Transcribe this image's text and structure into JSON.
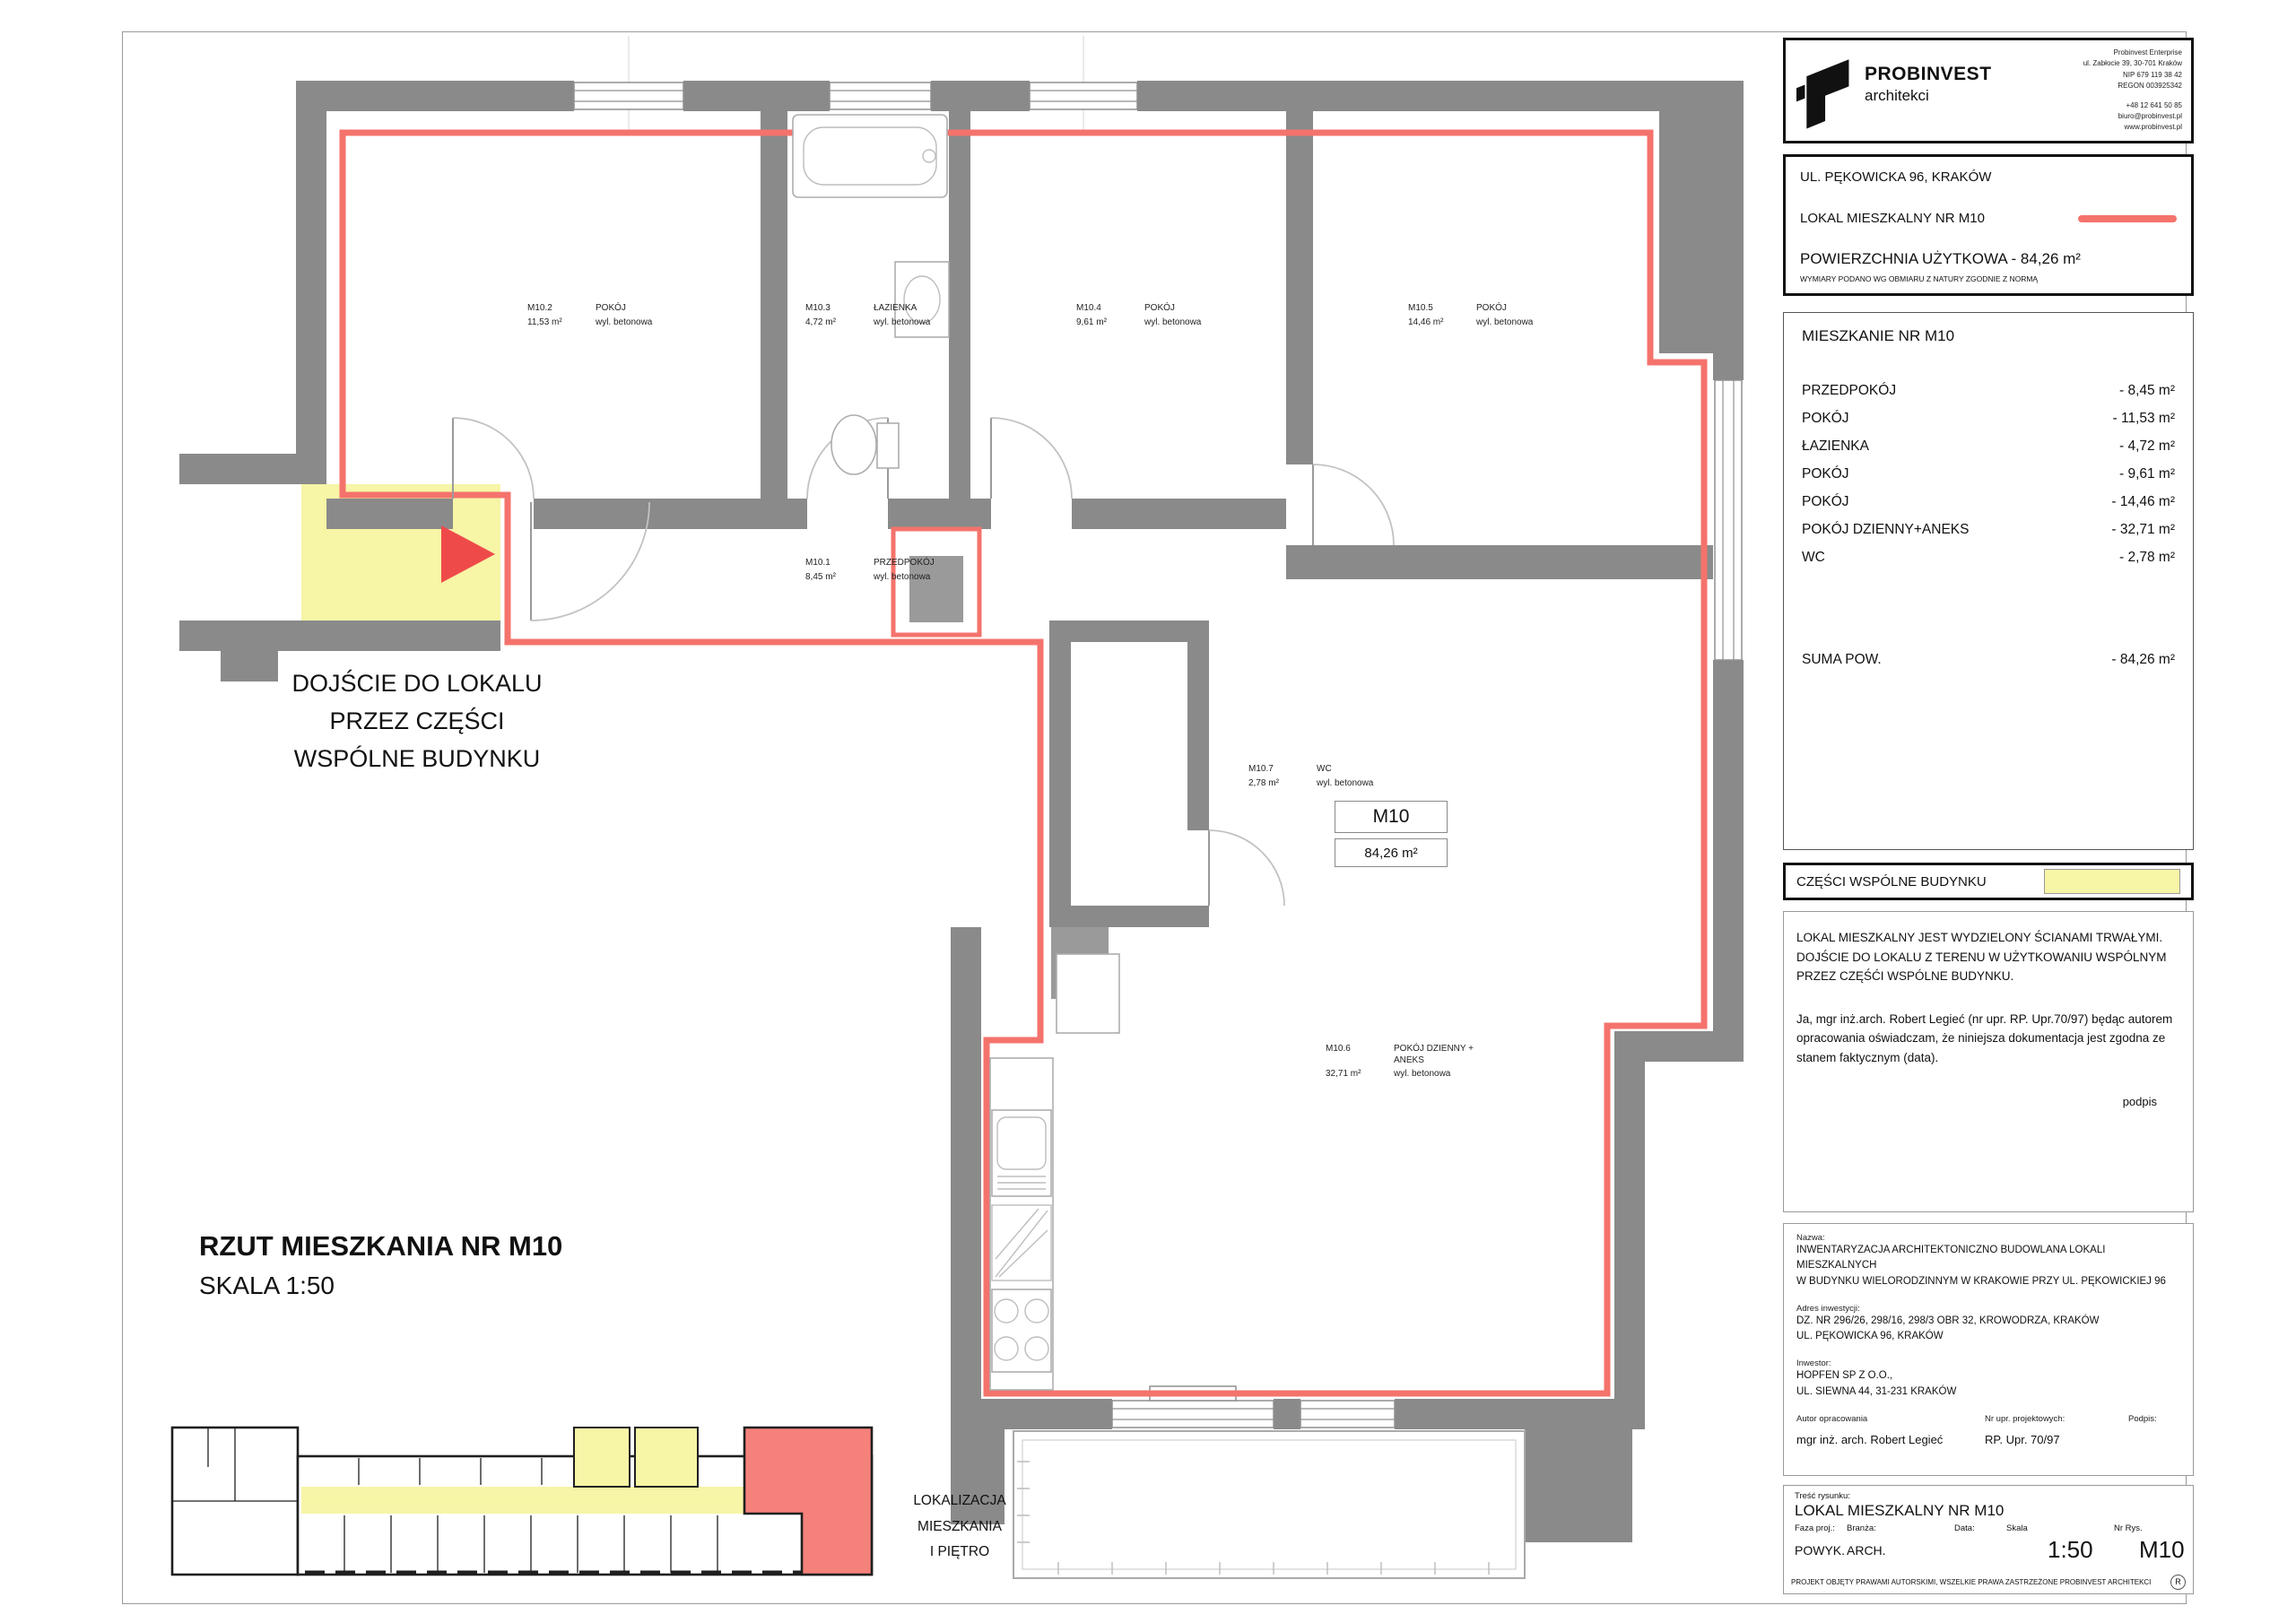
{
  "colors": {
    "wall": "#8a8a8a",
    "outline": "#f4736c",
    "common": "#f7f5a6",
    "arrow": "#ef4a4a",
    "unit": "#f5817b"
  },
  "logo": {
    "brand": "PROBINVEST",
    "brand_sub": "architekci",
    "company_top": [
      "Probinvest Enterprise",
      "ul. Zabłocie 39, 30-701 Kraków",
      "NIP 679 119 38 42",
      "REGON 003925342"
    ],
    "company_bottom": [
      "+48 12 641 50 85",
      "biuro@probinvest.pl",
      "www.probinvest.pl"
    ]
  },
  "header_box": {
    "address": "UL. PĘKOWICKA 96, KRAKÓW",
    "unit_label": "LOKAL MIESZKALNY NR M10",
    "area_label": "POWIERZCHNIA UŻYTKOWA - 84,26 m²",
    "area_note": "WYMIARY PODANO WG OBMIARU Z NATURY ZGODNIE Z NORMĄ"
  },
  "room_table": {
    "title": "MIESZKANIE NR M10",
    "rows": [
      {
        "label": "PRZEDPOKÓJ",
        "value": "- 8,45 m²"
      },
      {
        "label": "POKÓJ",
        "value": "- 11,53 m²"
      },
      {
        "label": "ŁAZIENKA",
        "value": "- 4,72 m²"
      },
      {
        "label": "POKÓJ",
        "value": "- 9,61 m²"
      },
      {
        "label": "POKÓJ",
        "value": "- 14,46 m²"
      },
      {
        "label": "POKÓJ DZIENNY+ANEKS",
        "value": "- 32,71 m²"
      },
      {
        "label": "WC",
        "value": "- 2,78 m²"
      }
    ],
    "total_label": "SUMA POW.",
    "total_value": "- 84,26 m²"
  },
  "common_parts": {
    "label": "CZĘŚCI WSPÓLNE BUDYNKU"
  },
  "statement": {
    "line1": "LOKAL MIESZKALNY JEST  WYDZIELONY ŚCIANAMI TRWAŁYMI.",
    "line2": "DOJŚCIE DO LOKALU Z TERENU W UŻYTKOWANIU WSPÓLNYM",
    "line3": "PRZEZ CZĘŚĆI WSPÓLNE BUDYNKU.",
    "declaration": "Ja, mgr inż.arch. Robert Legieć (nr upr. RP. Upr.70/97) będąc autorem opracowania oświadczam, że niniejsza dokumentacja jest zgodna ze stanem faktycznym (data).",
    "signature": "podpis"
  },
  "project_info": {
    "name_label": "Nazwa:",
    "name_line1": "INWENTARYZACJA  ARCHITEKTONICZNO BUDOWLANA LOKALI MIESZKALNYCH",
    "name_line2": "W BUDYNKU WIELORODZINNYM W KRAKOWIE PRZY UL. PĘKOWICKIEJ 96",
    "address_label": "Adres inwestycji:",
    "address_line1": "DZ. NR 296/26, 298/16, 298/3 OBR 32, KROWODRZA, KRAKÓW",
    "address_line2": "UL. PĘKOWICKA 96, KRAKÓW",
    "investor_label": "Inwestor:",
    "investor_line1": "HOPFEN SP Z O.O.,",
    "investor_line2": "UL. SIEWNA 44, 31-231 KRAKÓW",
    "author_label": "Autor opracowania",
    "author": "mgr inż. arch. Robert Legieć",
    "license_label": "Nr upr. projektowych:",
    "license": "RP. Upr. 70/97",
    "sign_label": "Podpis:"
  },
  "title_block": {
    "content_label": "Treść rysunku:",
    "content": "LOKAL MIESZKALNY NR M10",
    "phase_label": "Faza proj.:",
    "phase": "POWYK.",
    "branch_label": "Branża:",
    "branch": "ARCH.",
    "date_label": "Data:",
    "scale_label": "Skala",
    "scale": "1:50",
    "nr_label": "Nr Rys.",
    "nr": "M10",
    "copyright": "PROJEKT OBJĘTY PRAWAMI AUTORSKIMI, WSZELKIE PRAWA ZASTRZEŻONE PROBINVEST ARCHITEKCI",
    "r_mark": "R"
  },
  "plan": {
    "rooms": [
      {
        "id": "M10.1",
        "name": "PRZEDPOKÓJ",
        "area": "8,45 m²",
        "finish": "wyl. betonowa"
      },
      {
        "id": "M10.2",
        "name": "POKÓJ",
        "area": "11,53 m²",
        "finish": "wyl. betonowa"
      },
      {
        "id": "M10.3",
        "name": "ŁAZIENKA",
        "area": "4,72 m²",
        "finish": "wyl. betonowa"
      },
      {
        "id": "M10.4",
        "name": "POKÓJ",
        "area": "9,61 m²",
        "finish": "wyl. betonowa"
      },
      {
        "id": "M10.5",
        "name": "POKÓJ",
        "area": "14,46 m²",
        "finish": "wyl. betonowa"
      },
      {
        "id": "M10.6",
        "name": "POKÓJ DZIENNY + ANEKS",
        "area": "32,71 m²",
        "finish": "wyl. betonowa"
      },
      {
        "id": "M10.7",
        "name": "WC",
        "area": "2,78 m²",
        "finish": "wyl. betonowa"
      }
    ],
    "unit_tag": "M10",
    "unit_area": "84,26   m²",
    "entry_note": [
      "DOJŚCIE DO LOKALU",
      "PRZEZ CZĘŚCI",
      "WSPÓLNE BUDYNKU"
    ]
  },
  "plan_title": {
    "line1": "RZUT MIESZKANIA NR M10",
    "line2": "SKALA 1:50"
  },
  "location_note": {
    "lines": [
      "LOKALIZACJA",
      "MIESZKANIA",
      "I PIĘTRO"
    ]
  }
}
